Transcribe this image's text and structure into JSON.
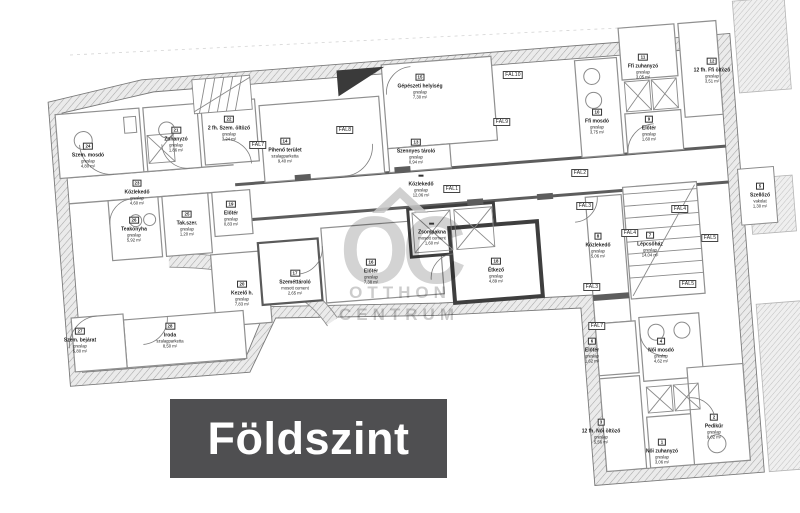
{
  "banner": {
    "label": "Földszint",
    "bg": "#4f4f51",
    "fg": "#ffffff"
  },
  "watermark": {
    "monogram": "OC",
    "line1": "OTTHON",
    "line2": "CENTRUM",
    "color": "#c8c8c8"
  },
  "plan": {
    "fal_tags": [
      "FAL1",
      "FAL2",
      "FAL3",
      "FAL3",
      "FAL4",
      "FAL4",
      "FAL5",
      "FAL5",
      "FAL7",
      "FAL7",
      "FAL8",
      "FAL9",
      "FAL10"
    ],
    "rooms": [
      {
        "num": "24",
        "name": "Szem. mosdó",
        "mat": "greslap",
        "area": "4,80 m²"
      },
      {
        "num": "21",
        "name": "Zuhanyzó",
        "mat": "greslap",
        "area": "1,86 m²"
      },
      {
        "num": "22",
        "name": "2 fh. Szem. öltöző",
        "mat": "greslap",
        "area": "3,24 m²"
      },
      {
        "num": "23",
        "name": "Közlekedő",
        "mat": "greslap",
        "area": "4,60 m²"
      },
      {
        "num": "25",
        "name": "Tak.szer.",
        "mat": "greslap",
        "area": "1,20 m²"
      },
      {
        "num": "26",
        "name": "Teakonyha",
        "mat": "greslap",
        "area": "5,92 m²"
      },
      {
        "num": "19",
        "name": "Előtér",
        "mat": "greslap",
        "area": "0,83 m²"
      },
      {
        "num": "27",
        "name": "Szem. bejárat",
        "mat": "greslap",
        "area": "5,80 m²"
      },
      {
        "num": "28",
        "name": "Iroda",
        "mat": "szalagparketta",
        "area": "8,50 m²"
      },
      {
        "num": "20",
        "name": "Kezelő h.",
        "mat": "greslap",
        "area": "7,83 m²"
      },
      {
        "num": "17",
        "name": "Szeméttároló",
        "mat": "mosott cement",
        "area": "2,65 m²"
      },
      {
        "num": "16",
        "name": "Előtér",
        "mat": "greslap",
        "area": "7,38 m²"
      },
      {
        "num": "",
        "name": "Zsompakna",
        "mat": "mosott cement",
        "area": "1,60 m²"
      },
      {
        "num": "14",
        "name": "Pihenő terület",
        "mat": "szalagparketta",
        "area": "9,40 m²"
      },
      {
        "num": "15",
        "name": "Gépészeti helyiség",
        "mat": "greslap",
        "area": "7,30 m²"
      },
      {
        "num": "13",
        "name": "Szennyes tároló",
        "mat": "greslap",
        "area": "0,94 m²"
      },
      {
        "num": "",
        "name": "Közlekedő",
        "mat": "greslap",
        "area": "12,06 m²"
      },
      {
        "num": "18",
        "name": "Étkező",
        "mat": "greslap",
        "area": "4,89 m²"
      },
      {
        "num": "11",
        "name": "Ffi zuhanyzó",
        "mat": "greslap",
        "area": "3,05 m²"
      },
      {
        "num": "12",
        "name": "12 fh. Ffi öltöző",
        "mat": "greslap",
        "area": "3,51 m²"
      },
      {
        "num": "10",
        "name": "Ffi mosdó",
        "mat": "greslap",
        "area": "3,75 m²"
      },
      {
        "num": "9",
        "name": "Előtér",
        "mat": "greslap",
        "area": "1,60 m²"
      },
      {
        "num": "8",
        "name": "Közlekedő",
        "mat": "greslap",
        "area": "5,06 m²"
      },
      {
        "num": "7",
        "name": "Lépcsőház",
        "mat": "greslap",
        "area": "14,04 m²"
      },
      {
        "num": "5",
        "name": "Szellőző",
        "mat": "vakolat",
        "area": "1,30 m²"
      },
      {
        "num": "6",
        "name": "Előtér",
        "mat": "greslap",
        "area": "1,62 m²"
      },
      {
        "num": "4",
        "name": "Női mosdó",
        "mat": "greslap",
        "area": "4,62 m²"
      },
      {
        "num": "3",
        "name": "12 fh. Női öltöző",
        "mat": "greslap",
        "area": "5,56 m²"
      },
      {
        "num": "1",
        "name": "Női zuhanyzó",
        "mat": "greslap",
        "area": "3,06 m²"
      },
      {
        "num": "2",
        "name": "Pedikűr",
        "mat": "greslap",
        "area": "9,02 m²"
      }
    ]
  }
}
